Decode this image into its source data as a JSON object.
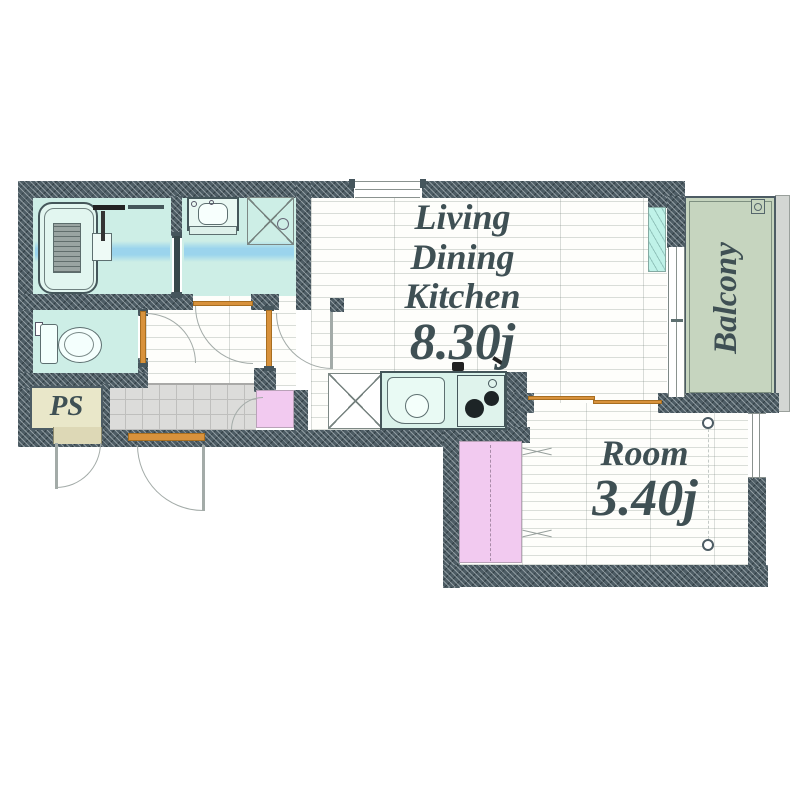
{
  "floorplan": {
    "ldk": {
      "lines": [
        "Living",
        "Dining",
        "Kitchen"
      ],
      "size": "8.30j"
    },
    "room": {
      "name": "Room",
      "size": "3.40j"
    },
    "balcony": {
      "label": "Balcony"
    },
    "ps": {
      "label": "PS"
    },
    "colors": {
      "wall": "#4d5c64",
      "room_mint": "#cdeee6",
      "water_band": "#92d0ee",
      "balcony_green": "#c6d5bf",
      "closet_pink": "#f2caf0",
      "ps_beige": "#e9e7c9",
      "entrance_gray": "#dcdcda",
      "door_frame_orange": "#d8923c",
      "label_text": "#3f5054",
      "outer_wall_gray": "#d3d6d3"
    },
    "fixtures": [
      "bathtub",
      "shower",
      "vanity-basin",
      "washing-machine-space",
      "toilet",
      "refrigerator-space",
      "kitchen-sink",
      "gas-stove",
      "balcony-drain",
      "closet",
      "pipe-space",
      "sliding-window"
    ]
  }
}
